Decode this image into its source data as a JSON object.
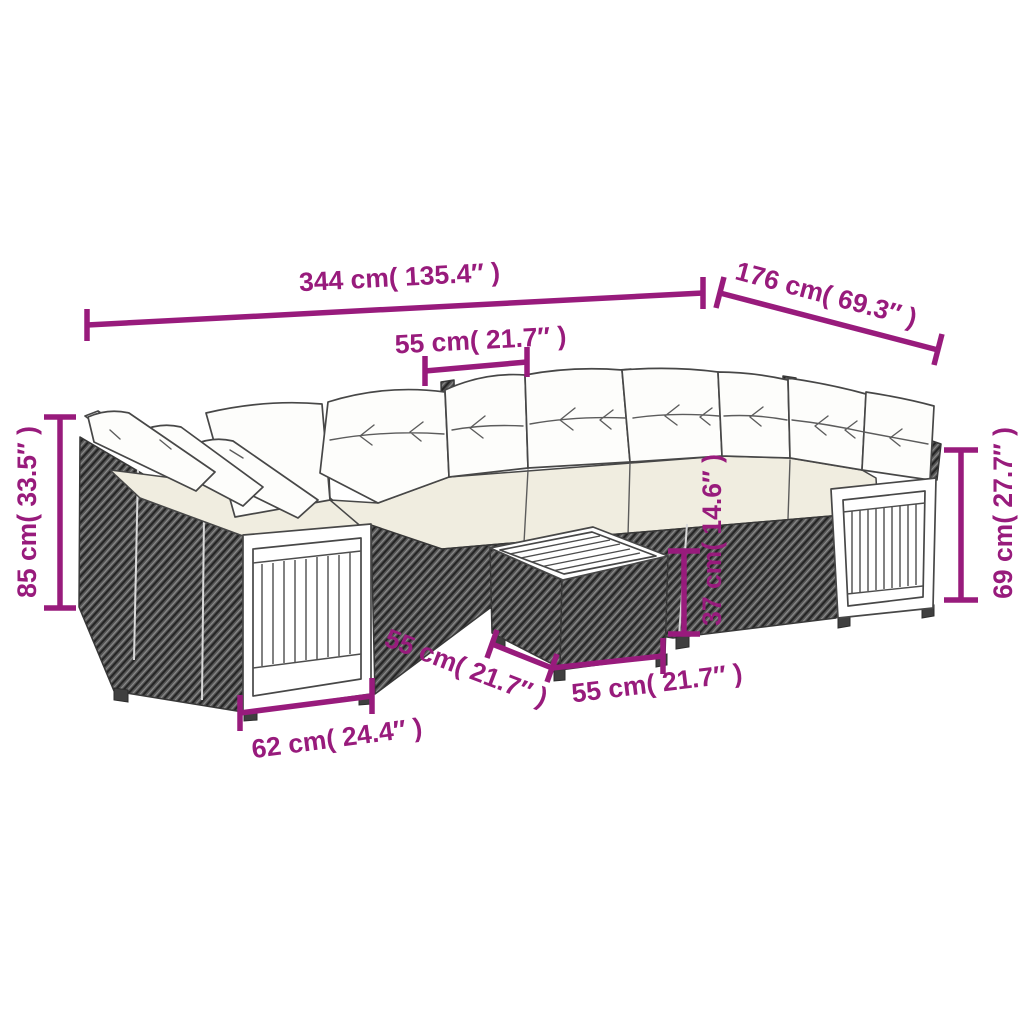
{
  "figure": {
    "kind": "product-dimension-diagram",
    "subject": "poly-rattan-garden-corner-sofa-set-with-wood-slat-panels-and-coffee-table",
    "background": "#FFFFFF"
  },
  "palette": {
    "dimension_annotation": "#981B7C",
    "outline": "#474747",
    "rattan_weave": "#555555",
    "seat_cushion": "#F0EDE0",
    "back_cushion": "#FDFDFB",
    "wood_panel": "#FFFFFF"
  },
  "dimensions": {
    "overall_width": {
      "label": "344 cm( 135.4″ )"
    },
    "overall_depth": {
      "label": "176 cm( 69.3″ )"
    },
    "seat_width": {
      "label": "55 cm( 21.7″ )"
    },
    "back_height": {
      "label": "85 cm( 33.5″ )"
    },
    "arm_height": {
      "label": "69 cm( 27.7″ )"
    },
    "table_height": {
      "label": "37 cm( 14.6″ )"
    },
    "table_depth": {
      "label": "55 cm( 21.7″ )"
    },
    "table_width": {
      "label": "55 cm( 21.7″ )"
    },
    "arm_module_width": {
      "label": "62 cm( 24.4″ )"
    }
  }
}
